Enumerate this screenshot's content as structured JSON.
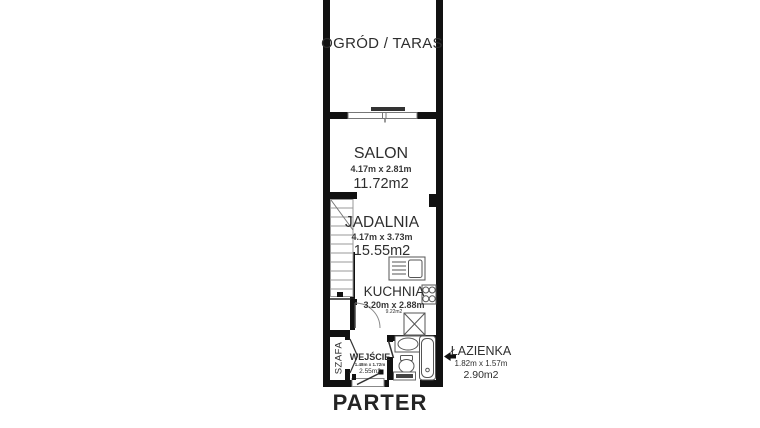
{
  "plan_title": "PARTER",
  "rooms": {
    "terrace": {
      "label": "OGRÓD / TARAS"
    },
    "salon": {
      "label": "SALON",
      "dimensions": "4.17m x 2.81m",
      "area": "11.72m2"
    },
    "dining": {
      "label": "JADALNIA",
      "dimensions": "4.17m x 3.73m",
      "area": "15.55m2"
    },
    "kitchen": {
      "label": "KUCHNIA",
      "dimensions": "3.20m x 2.88m",
      "area": "9.22m2"
    },
    "entrance": {
      "label": "WEJŚCIE",
      "dimensions": "1.48m x 1.72m",
      "area": "2.55m2"
    },
    "wardrobe": {
      "label": "SZAFA"
    },
    "bathroom": {
      "label": "ŁAZIENKA",
      "dimensions": "1.82m x 1.57m",
      "area": "2.90m2"
    }
  },
  "colors": {
    "wall": "#111111",
    "text": "#2e2e2e",
    "fixture_stroke": "#555555",
    "background": "#ffffff"
  }
}
